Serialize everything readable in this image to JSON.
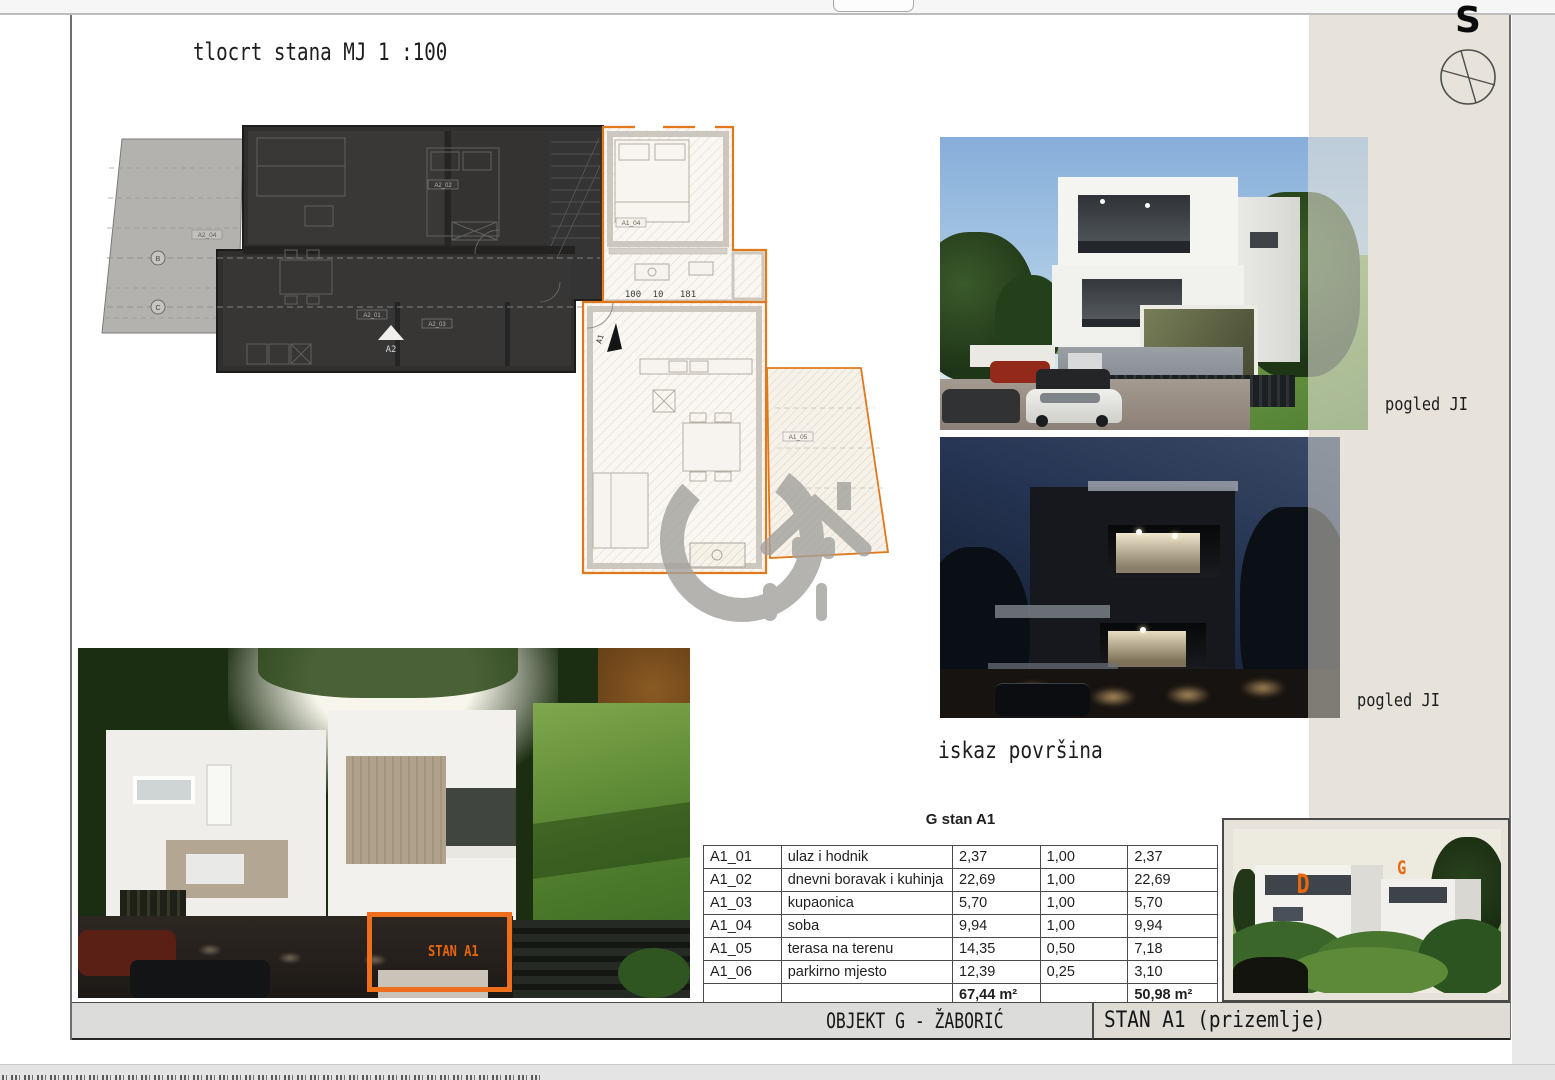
{
  "sheet": {
    "scale_title": "tlocrt stana MJ 1 :100",
    "north_label": "S",
    "view_label_1": "pogled JI",
    "view_label_2": "pogled JI",
    "areas_heading": "iskaz površina"
  },
  "plan": {
    "a2_marker": "A2",
    "a1_marker": "A1",
    "grid_b": "B",
    "grid_c": "C",
    "dim_1": "100",
    "dim_2": "10",
    "dim_3": "181",
    "label_a1_04": "A1_04",
    "label_a1_01": "A1_01",
    "label_a1_05": "A1_05",
    "label_a2_01": "A2_01",
    "label_a2_02": "A2_02",
    "label_a2_03": "A2_03",
    "label_a2_04": "A2_04"
  },
  "table": {
    "title": "G stan A1",
    "rows": [
      [
        "A1_01",
        "ulaz i hodnik",
        "2,37",
        "1,00",
        "2,37"
      ],
      [
        "A1_02",
        "dnevni boravak i kuhinja",
        "22,69",
        "1,00",
        "22,69"
      ],
      [
        "A1_03",
        "kupaonica",
        "5,70",
        "1,00",
        "5,70"
      ],
      [
        "A1_04",
        "soba",
        "9,94",
        "1,00",
        "9,94"
      ],
      [
        "A1_05",
        "terasa na terenu",
        "14,35",
        "0,50",
        "7,18"
      ],
      [
        "A1_06",
        "parkirno mjesto",
        "12,39",
        "0,25",
        "3,10"
      ],
      [
        "",
        "",
        "67,44 m²",
        "",
        "50,98 m²"
      ]
    ]
  },
  "renders": {
    "big_annotation": "STAN A1",
    "small_label_d": "D",
    "small_label_g": "G"
  },
  "footer": {
    "left": "OBJEKT G - ŽABORIĆ",
    "right": "STAN A1 (prizemlje)"
  },
  "colors": {
    "accent_orange": "#E8751E",
    "annotation_orange": "#EE6E1B",
    "beige_panel": "#E7E3DA",
    "plan_dark": "#31302F"
  }
}
